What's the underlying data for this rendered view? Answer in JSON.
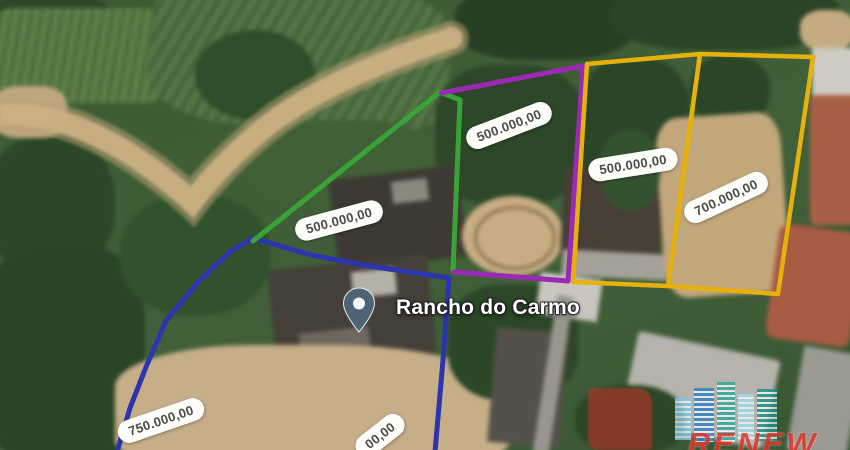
{
  "map": {
    "place": {
      "name": "Rancho do Carmo"
    },
    "parcels": [
      {
        "id": "green",
        "outline_color": "#3aa338",
        "price": "500.000,00"
      },
      {
        "id": "purple",
        "outline_color": "#9a2ab4",
        "price": "500.000,00"
      },
      {
        "id": "yellow-left",
        "outline_color": "#e7b10c",
        "price": "500.000,00"
      },
      {
        "id": "yellow-right",
        "outline_color": "#e7b10c",
        "price": "700.000,00"
      },
      {
        "id": "blue",
        "outline_color": "#2c35ae",
        "price": "750.000,00"
      },
      {
        "id": "bottom-cropped",
        "outline_color": "#2c35ae",
        "price_fragment": "00,00"
      }
    ],
    "watermark": {
      "text": "RENEW",
      "color": "#e2342c"
    }
  }
}
